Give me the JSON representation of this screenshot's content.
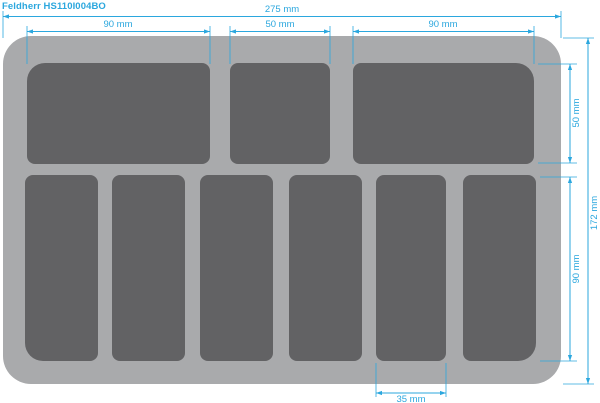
{
  "title": "Feldherr HS110I004BO",
  "colors": {
    "background": "#ffffff",
    "tray": "#a9aaac",
    "compartment": "#626264",
    "dimension": "#2ba7de"
  },
  "diagram": {
    "type": "foam-tray-cutting-plan",
    "tray_width_mm": 275,
    "tray_height_mm": 172,
    "top_row": {
      "compartment_count": 3,
      "compartment_widths_mm": [
        90,
        50,
        90
      ],
      "height_mm": 50
    },
    "bottom_row": {
      "compartment_count": 6,
      "compartment_width_mm": 35,
      "height_mm": 90
    }
  },
  "dimensions": {
    "top_total": "275 mm",
    "top_left": "90 mm",
    "top_middle": "50 mm",
    "top_right": "90 mm",
    "right_top": "50 mm",
    "right_bottom": "90 mm",
    "right_total": "172 mm",
    "bottom_slot": "35 mm"
  }
}
